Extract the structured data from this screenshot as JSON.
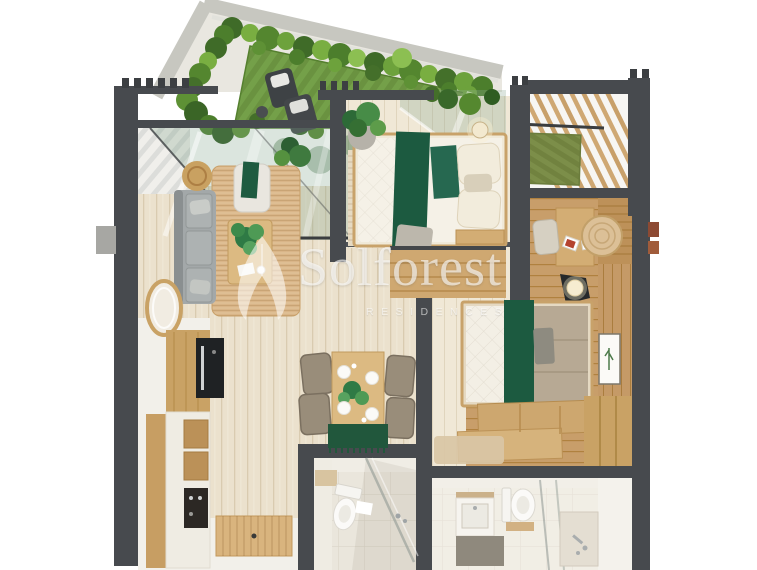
{
  "watermark": {
    "brand": "Solforest",
    "subtitle": "RESIDENCES",
    "logo_icon": "leaf-logo-icon",
    "text_color": "rgba(255,255,255,0.6)"
  },
  "palette": {
    "background": "#ffffff",
    "wall_dark": "#474a4e",
    "concrete_edge": "#c7c7c0",
    "hedge_dark": "#3f6b28",
    "hedge_light": "#79ae41",
    "lawn_green": "#6a9240",
    "turf_green": "#7c8e49",
    "plank_light": "#ebe1cd",
    "plank_warm": "#c89e6a",
    "wood_furniture": "#d3ad74",
    "sofa_grey": "#a3a8a9",
    "accent_green": "#1c5a40",
    "taupe_bedding": "#b7a994",
    "bathroom_tile": "#eae6dc",
    "rust_accent": "#8d4a33"
  },
  "scene": {
    "type": "3d-apartment-floor-plan-render",
    "rooms": [
      {
        "name": "garden-terrace",
        "items": [
          "hedge",
          "lawn",
          "lounge-chair",
          "lounge-chair",
          "side-table"
        ]
      },
      {
        "name": "pergola-balcony",
        "items": [
          "wood-slats",
          "turf-mat",
          "beam"
        ]
      },
      {
        "name": "living-room",
        "items": [
          "sofa",
          "coffee-table",
          "potted-plant",
          "armchair",
          "rattan-pouf",
          "jute-rug",
          "oval-mirror"
        ]
      },
      {
        "name": "kitchen",
        "items": [
          "tall-cabinet",
          "oven",
          "counter",
          "drawers",
          "cooktop",
          "entry-mat"
        ]
      },
      {
        "name": "dining-area",
        "items": [
          "dining-table",
          "dining-chair",
          "dining-chair",
          "dining-chair",
          "dining-chair",
          "plates",
          "centerpiece-plant",
          "green-table-runner"
        ]
      },
      {
        "name": "bedroom-1",
        "items": [
          "double-bed",
          "green-runner",
          "pillows",
          "striped-rug",
          "potted-plant",
          "pendant-light",
          "bench",
          "wardrobe",
          "glass-wall"
        ]
      },
      {
        "name": "bedroom-2",
        "items": [
          "double-bed",
          "green-runner",
          "desk",
          "desk-chair",
          "books",
          "round-rug",
          "floor-lamp",
          "foot-bench",
          "wardrobe",
          "wall-art",
          "rug"
        ]
      },
      {
        "name": "bathroom-1",
        "items": [
          "toilet",
          "shower",
          "glass-partition",
          "bath-mat",
          "wall-cabinet"
        ]
      },
      {
        "name": "bathroom-2",
        "items": [
          "toilet",
          "vanity-sink",
          "shower-tray",
          "glass-partition",
          "dark-floor-mat"
        ]
      }
    ]
  }
}
